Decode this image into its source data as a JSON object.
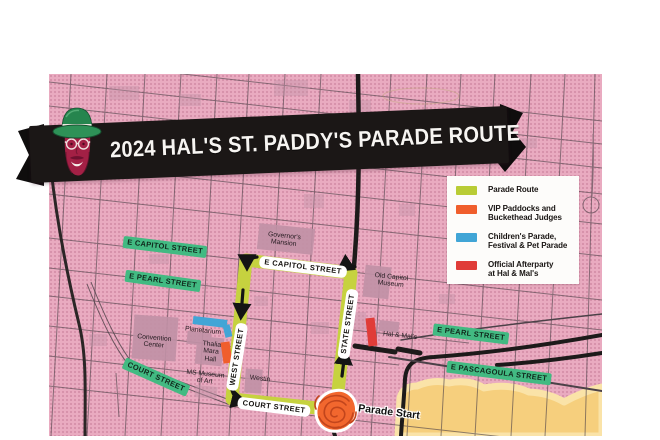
{
  "banner": {
    "title": "2024 HAL'S ST. PADDY'S PARADE ROUTE",
    "mascot": "hal-face-green-bowler-hat"
  },
  "legend": {
    "items": [
      {
        "color": "#b9cc35",
        "line1": "Parade Route",
        "line2": ""
      },
      {
        "color": "#f05e2c",
        "line1": "VIP Paddocks and",
        "line2": "Buckethead Judges"
      },
      {
        "color": "#41a5d6",
        "line1": "Children's Parade,",
        "line2": "Festival & Pet Parade"
      },
      {
        "color": "#e03c38",
        "line1": "Official Afterparty",
        "line2": "at Hal & Mal's"
      }
    ]
  },
  "map": {
    "highlighted_streets": [
      {
        "name": "E CAPITOL STREET"
      },
      {
        "name": "E PEARL STREET"
      },
      {
        "name": "COURT STREET"
      },
      {
        "name": "E PEARL STREET"
      },
      {
        "name": "E PASCAGOULA STREET"
      }
    ],
    "route_streets": [
      {
        "name": "E CAPITOL STREET"
      },
      {
        "name": "STATE STREET"
      },
      {
        "name": "WEST STREET"
      },
      {
        "name": "COURT STREET"
      }
    ],
    "buildings": [
      {
        "line1": "Governor's",
        "line2": "Mansion",
        "line3": ""
      },
      {
        "line1": "Old Capitol",
        "line2": "Museum",
        "line3": ""
      },
      {
        "line1": "Convention",
        "line2": "Center",
        "line3": ""
      },
      {
        "line1": "Planetarium",
        "line2": "",
        "line3": ""
      },
      {
        "line1": "Thalia",
        "line2": "Mara",
        "line3": "Hall"
      },
      {
        "line1": "MS Museum",
        "line2": "of Art",
        "line3": ""
      },
      {
        "line1": "Westin",
        "line2": "",
        "line3": ""
      },
      {
        "line1": "Hal & Mal's",
        "line2": "",
        "line3": ""
      }
    ],
    "start_marker": {
      "label": "Parade Start",
      "icon": "rose-icon"
    }
  },
  "colors": {
    "map_pink": "#e9abc0",
    "route_green": "#c6d23f",
    "highlight_green": "#42ba82",
    "park_yellow": "#f6cf7d",
    "building_mauve": "#c191a6",
    "banner_black": "#1b1716"
  }
}
